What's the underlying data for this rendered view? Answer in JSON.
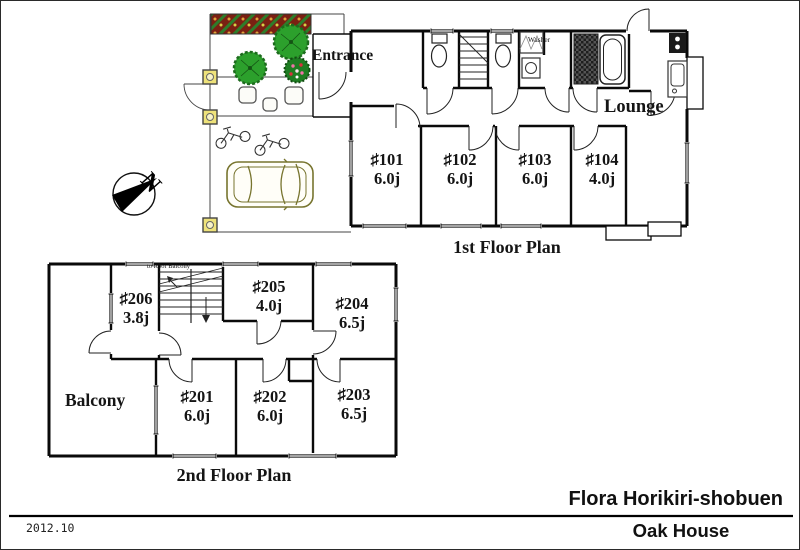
{
  "footer": {
    "date": "2012.10",
    "property_name": "Flora Horikiri-shobuen",
    "building_name": "Oak House"
  },
  "compass": {
    "north_label": "N"
  },
  "first_floor": {
    "plan_label": "1st Floor Plan",
    "entrance_label": "Entrance",
    "lounge_label": "Lounge",
    "washer_label": "Washer",
    "rooms": [
      {
        "number": "♯101",
        "size": "6.0j"
      },
      {
        "number": "♯102",
        "size": "6.0j"
      },
      {
        "number": "♯103",
        "size": "6.0j"
      },
      {
        "number": "♯104",
        "size": "4.0j"
      }
    ]
  },
  "second_floor": {
    "plan_label": "2nd Floor Plan",
    "balcony_label": "Balcony",
    "stairs_note": "to Roof Balcony",
    "rooms": [
      {
        "number": "♯206",
        "size": "3.8j"
      },
      {
        "number": "♯205",
        "size": "4.0j"
      },
      {
        "number": "♯204",
        "size": "6.5j"
      },
      {
        "number": "♯201",
        "size": "6.0j"
      },
      {
        "number": "♯202",
        "size": "6.0j"
      },
      {
        "number": "♯203",
        "size": "6.5j"
      }
    ]
  },
  "colors": {
    "wall": "#0a0a0a",
    "tree_green": "#2ca02c",
    "flower_bed_red": "#7a2012",
    "post_yellow": "#eee27a",
    "car_outline": "#77742e"
  }
}
